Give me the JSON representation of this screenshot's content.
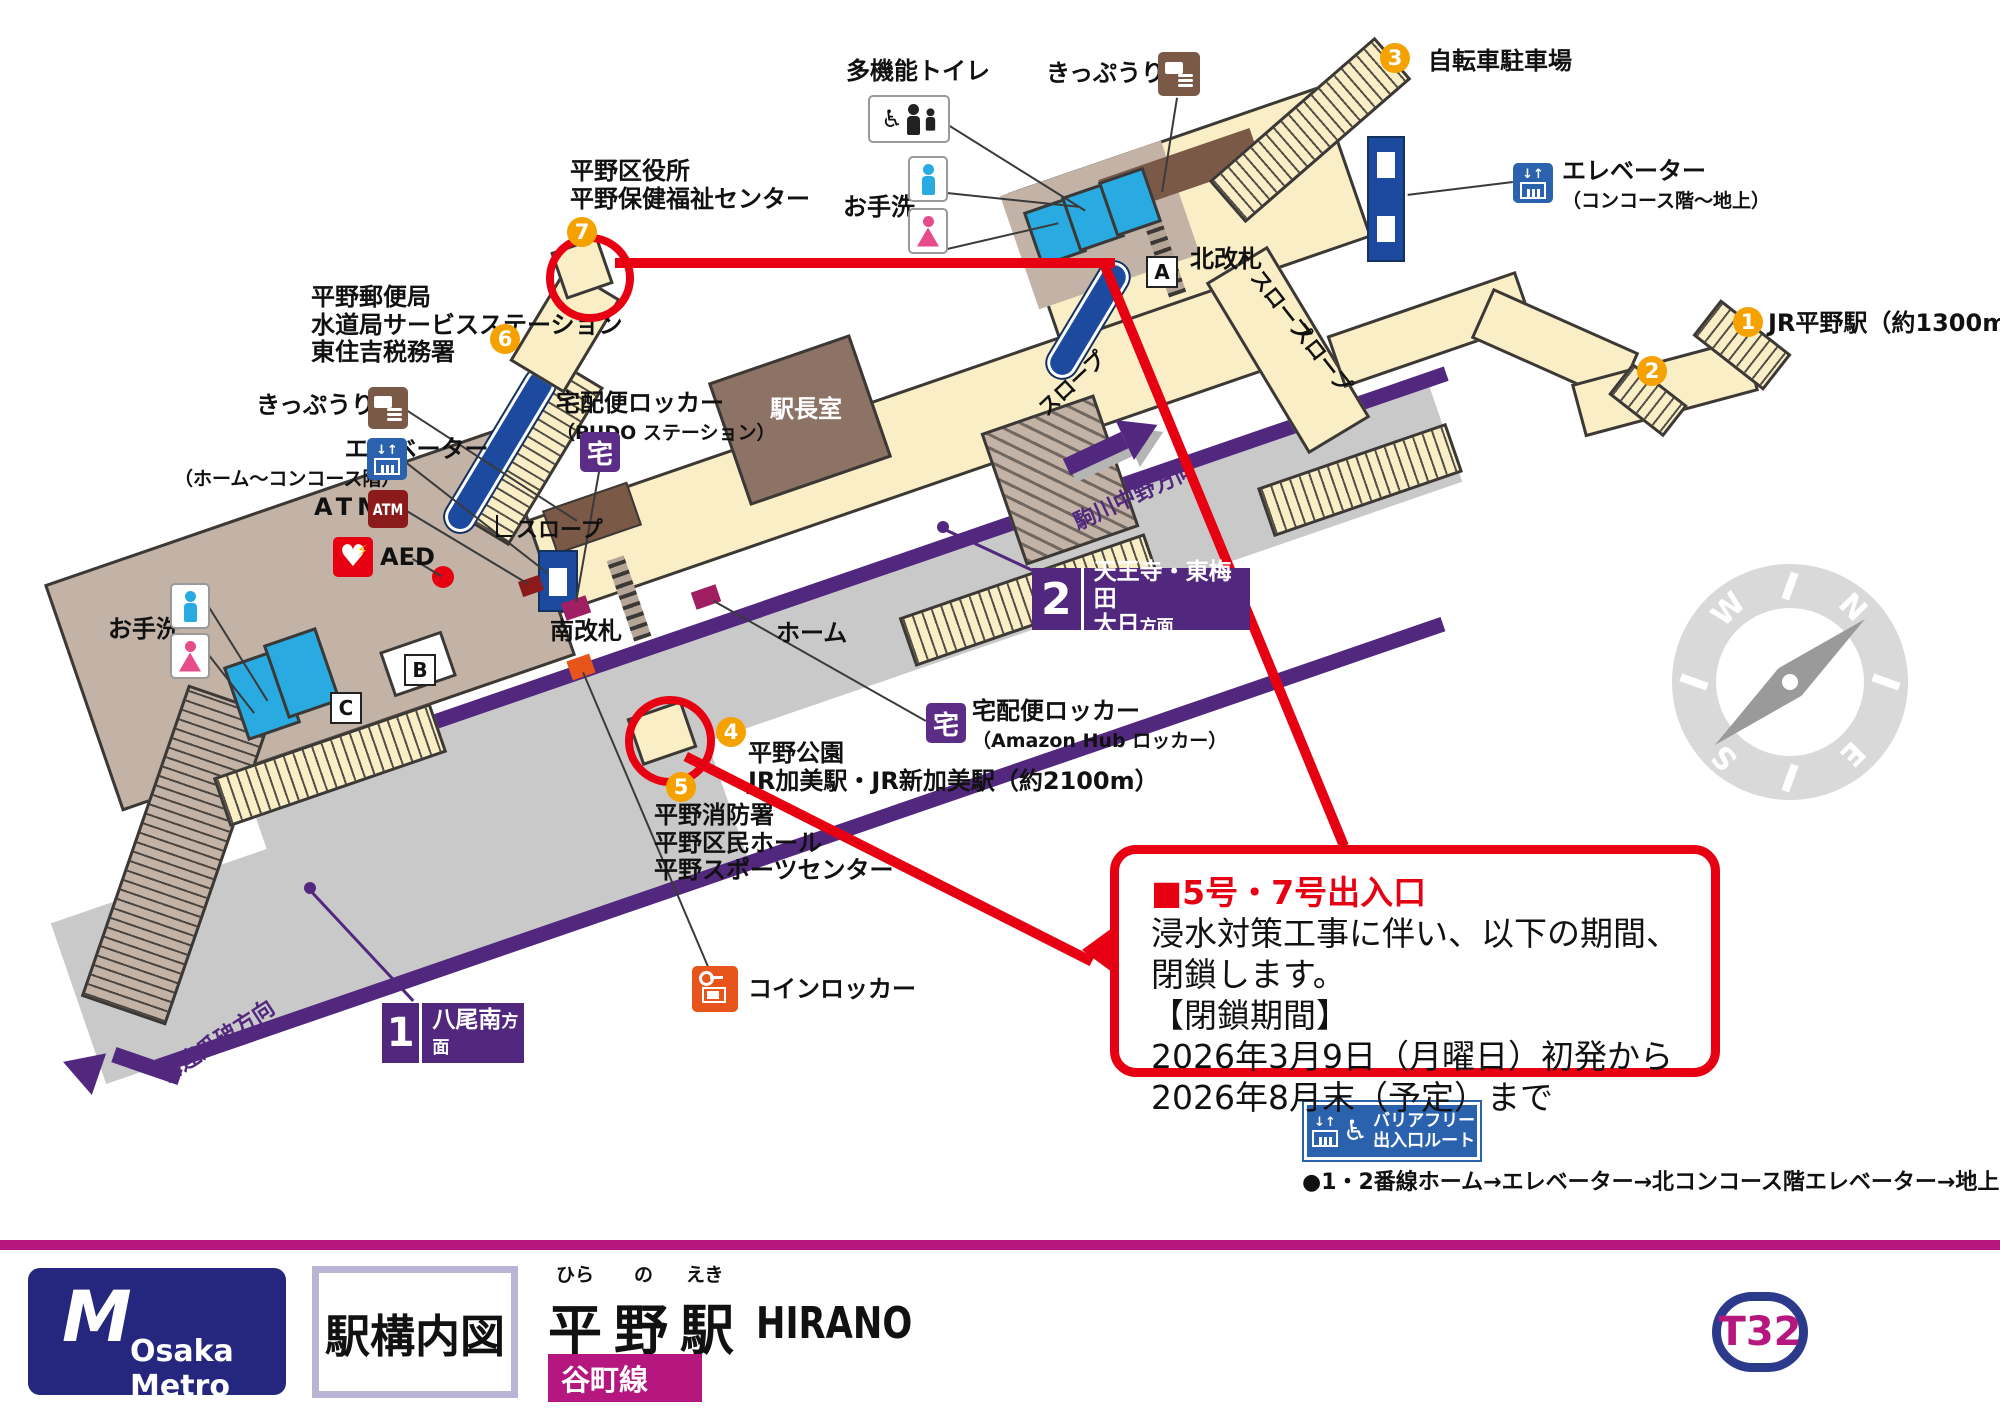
{
  "map": {
    "facilities": {
      "multi_toilet": "多機能トイレ",
      "restroom": "お手洗",
      "ticket_office": "きっぷうりば",
      "elevator": "エレベーター",
      "elevator_concourse_ground": "（コンコース階～地上）",
      "elevator_home_concourse": "（ホーム～コンコース階）",
      "atm": "ATM",
      "aed": "AED",
      "coin_locker": "コインロッカー",
      "delivery_locker": "宅配便ロッカー",
      "pudo": "（PUDO ステーション）",
      "amazon_hub": "（Amazon Hub ロッカー）",
      "taku": "宅",
      "station_office": "駅長室",
      "north_gate": "北改札",
      "south_gate": "南改札",
      "platform": "ホーム",
      "slope": "スロープ",
      "bicycle_parking": "自転車駐車場"
    },
    "exits": {
      "n1": "1",
      "n2": "2",
      "n3": "3",
      "n4": "4",
      "n5": "5",
      "n6": "6",
      "n7": "7",
      "exit1_label": "JR平野駅（約1300m）",
      "exit4_lines": [
        "平野公園",
        "JR加美駅・JR新加美駅（約2100m）"
      ],
      "exit5_lines": [
        "平野消防署",
        "平野区民ホール",
        "平野スポーツセンター"
      ],
      "exit6_lines": [
        "平野郵便局",
        "水道局サービスステーション",
        "東住吉税務署"
      ],
      "exit7_lines": [
        "平野区役所",
        "平野保健福祉センター"
      ]
    },
    "gate_letters": {
      "a": "A",
      "b": "B",
      "c": "C"
    },
    "directions": {
      "komagawa": "駒川中野方向",
      "kire": "喜連瓜破方向",
      "track2": {
        "num": "2",
        "line1": "天王寺・東梅田",
        "dest": "大日",
        "suffix": "方面"
      },
      "track1": {
        "num": "1",
        "dest": "八尾南",
        "suffix": "方面"
      }
    },
    "notice": {
      "title": "■5号・7号出入口",
      "line1": "浸水対策工事に伴い、以下の期間、閉鎖します。",
      "line2": "【閉鎖期間】",
      "line3": "2026年3月9日（月曜日）初発から",
      "line4": "2026年8月末（予定）まで"
    },
    "barrier_free": {
      "badge_line1": "バリアフリー",
      "badge_line2": "出入口ルート",
      "route": "●1・2番線ホーム→エレベーター→北コンコース階エレベーター→地上"
    },
    "compass": {
      "n": "N",
      "e": "E",
      "s": "S",
      "w": "W"
    }
  },
  "footer": {
    "brand": "Osaka Metro",
    "logo_mark": "M",
    "doc_type": "駅構内図",
    "station_furigana": [
      "ひら",
      "の",
      "えき"
    ],
    "station_name": "平野駅",
    "station_romaji": "HIRANO",
    "line_name": "谷町線",
    "station_code": "T32"
  },
  "colors": {
    "accent_orange": "#f5a200",
    "alert_red": "#e60012",
    "line_purple": "#52287f",
    "brand_magenta": "#b5177e",
    "elevator_navy": "#1c4a9e",
    "restroom_blue": "#29abe2",
    "female_pink": "#e64b8b",
    "path_beige": "#faeec6",
    "paid_area_taupe": "#c2b3a6",
    "counter_brown": "#7b5947"
  },
  "icons": {
    "wheelchair_glyph": "♿",
    "elevator_arrows": "↓↑",
    "names": [
      "wheelchair-icon",
      "person-icon",
      "baby-icon",
      "ticket-machine-icon",
      "elevator-icon",
      "atm-icon",
      "aed-icon",
      "delivery-locker-icon",
      "coin-locker-icon",
      "key-icon",
      "compass-icon",
      "direction-arrow-icon"
    ]
  }
}
